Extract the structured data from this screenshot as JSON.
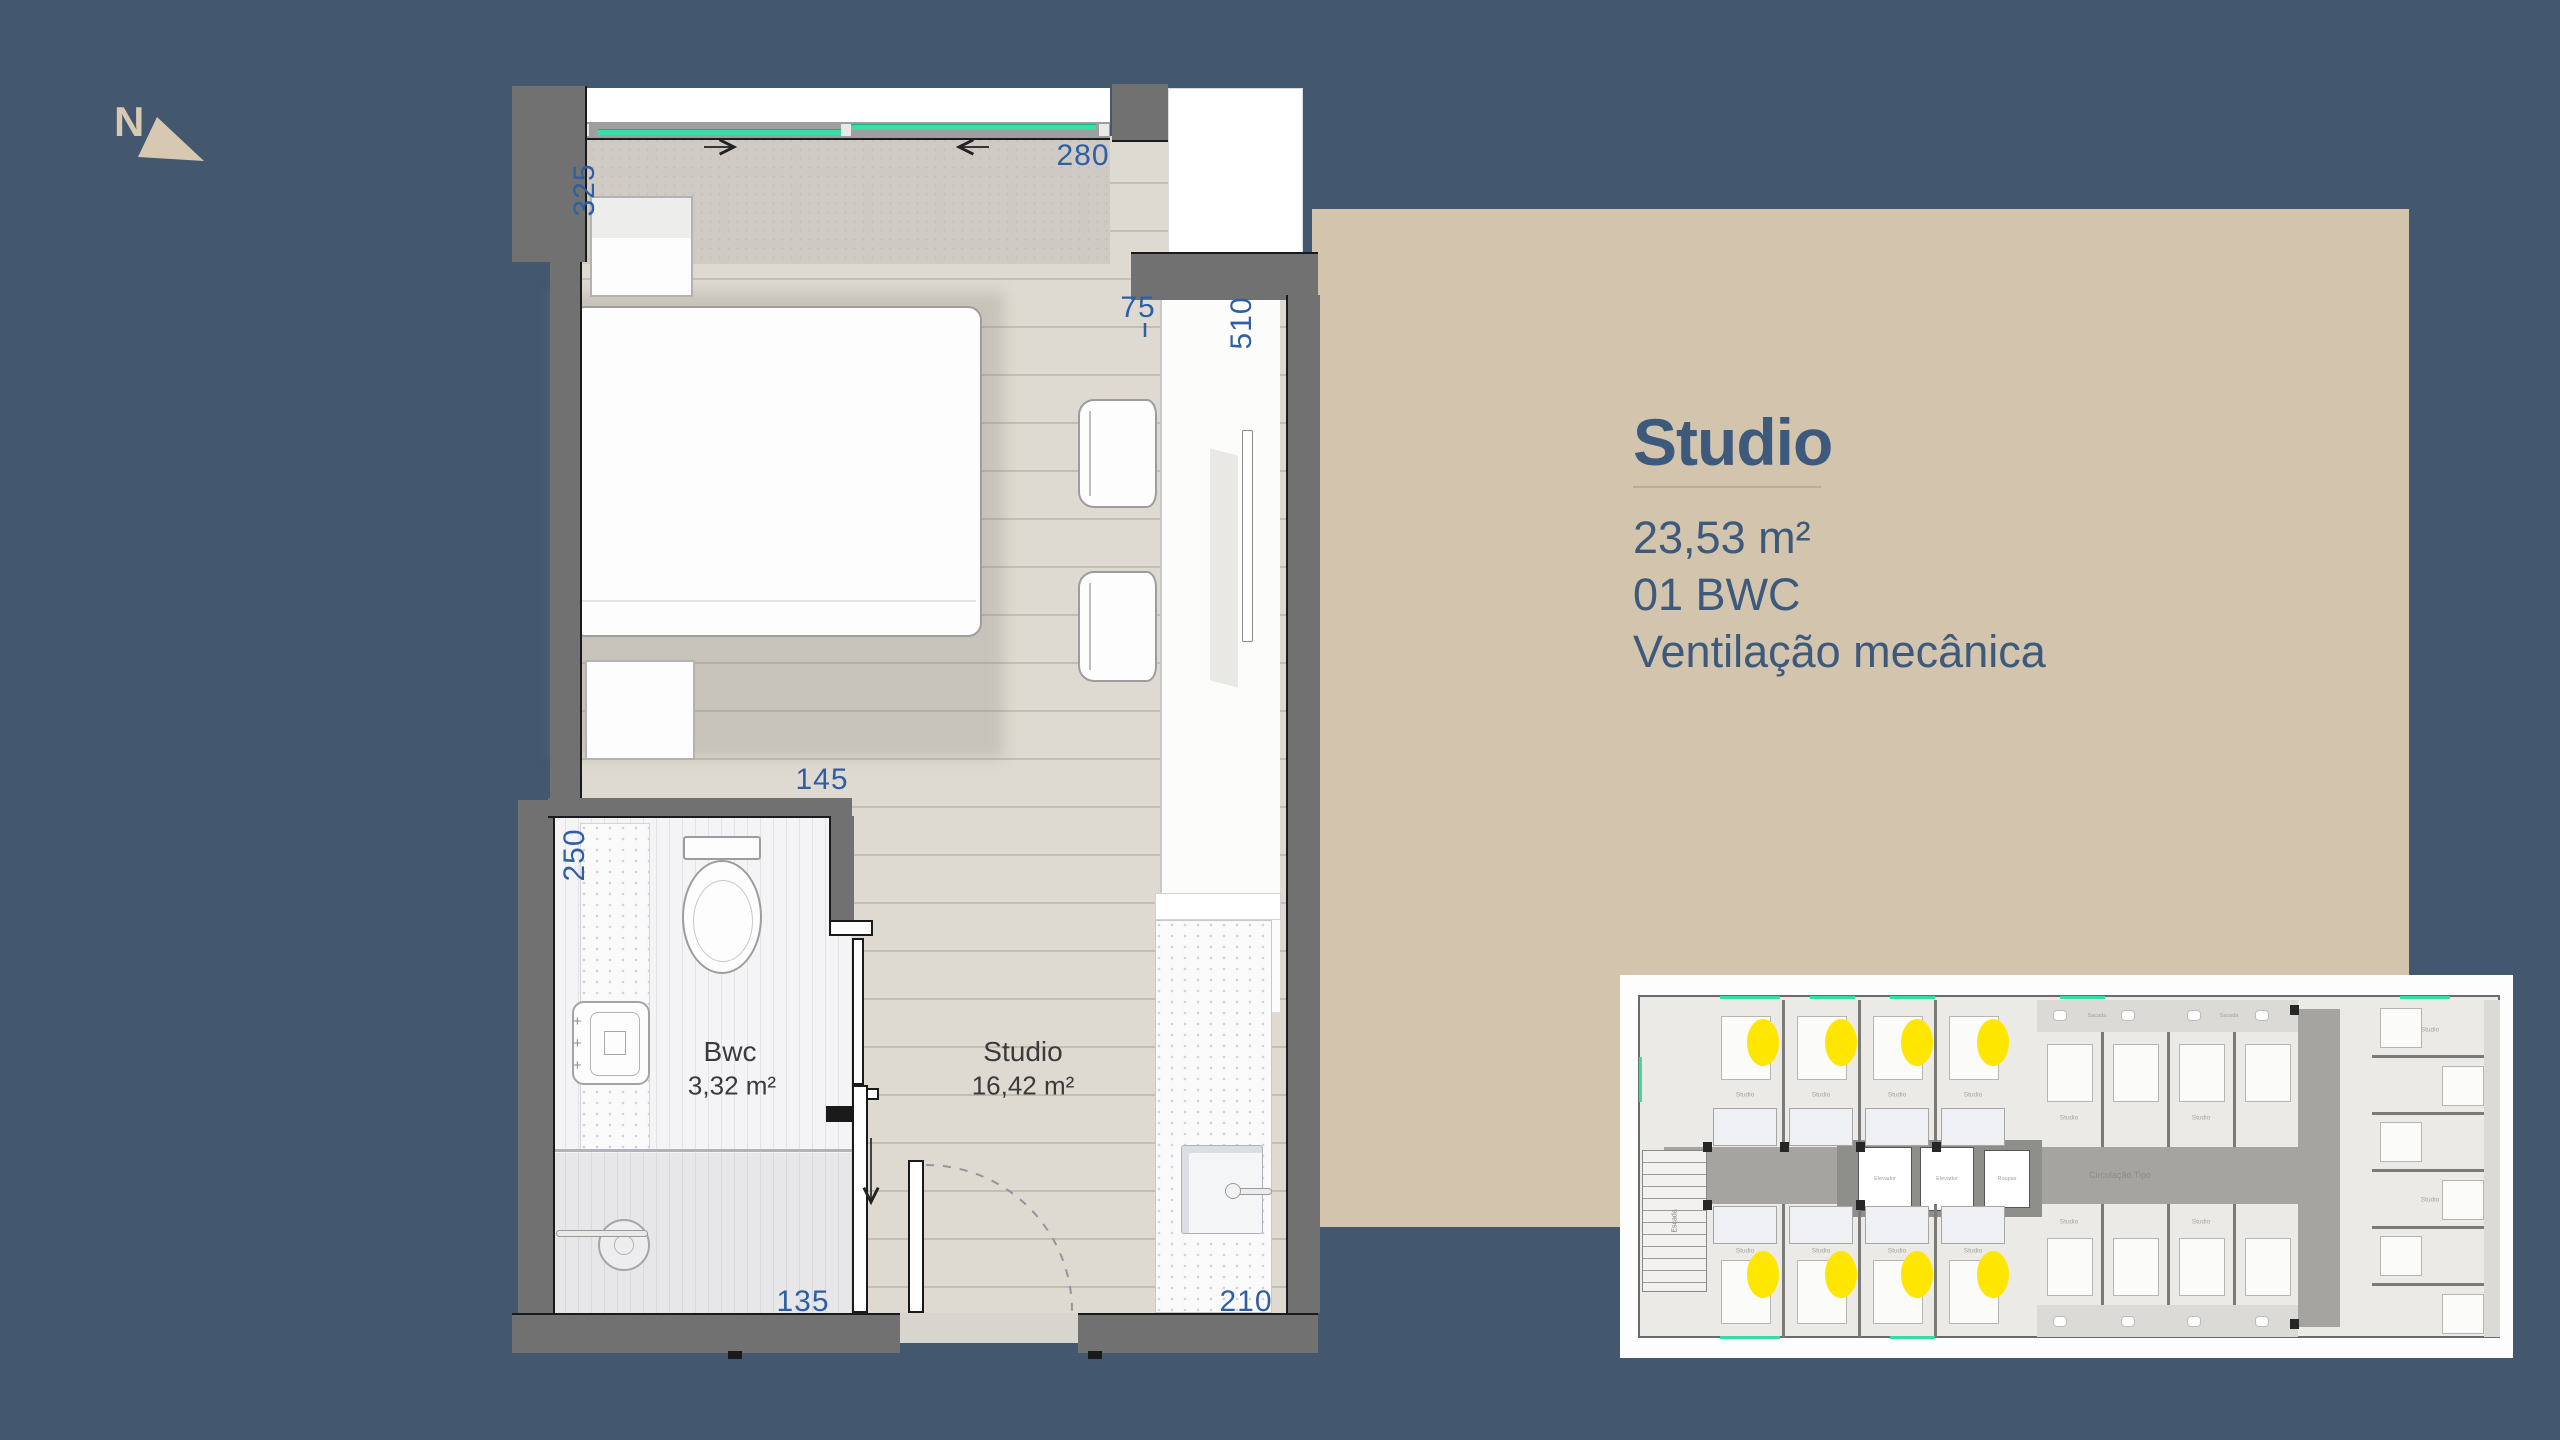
{
  "page": {
    "background": "#43576F"
  },
  "north": {
    "label": "N"
  },
  "panel": {
    "background": "#D2C4AD",
    "text_color": "#3D5A7C",
    "title": "Studio",
    "spec_area": "23,53 m²",
    "spec_bwc": "01 BWC",
    "spec_ventilation": "Ventilação mecânica"
  },
  "plan": {
    "rooms": {
      "bwc": {
        "name": "Bwc",
        "area": "3,32 m²"
      },
      "studio": {
        "name": "Studio",
        "area": "16,42 m²"
      }
    },
    "dims": {
      "left_height": "325",
      "top_width": "280",
      "nook_depth": "75",
      "counter_length": "510",
      "bath_width": "145",
      "bath_height": "250",
      "shower_width": "135",
      "kitchen_width": "210"
    },
    "colors": {
      "wall": "#717171",
      "window_glass": "#3CDCA6",
      "dimension_text": "#2E5FA3"
    }
  },
  "key_plan": {
    "highlight_color": "#FFE600",
    "highlighted_units": 8,
    "labels": {
      "circulation": "Circulação Tipo",
      "stairs": "Escada",
      "elevator": "Elevador",
      "linen": "Roupas",
      "balcony": "Sacada",
      "unit": "Studio"
    }
  }
}
